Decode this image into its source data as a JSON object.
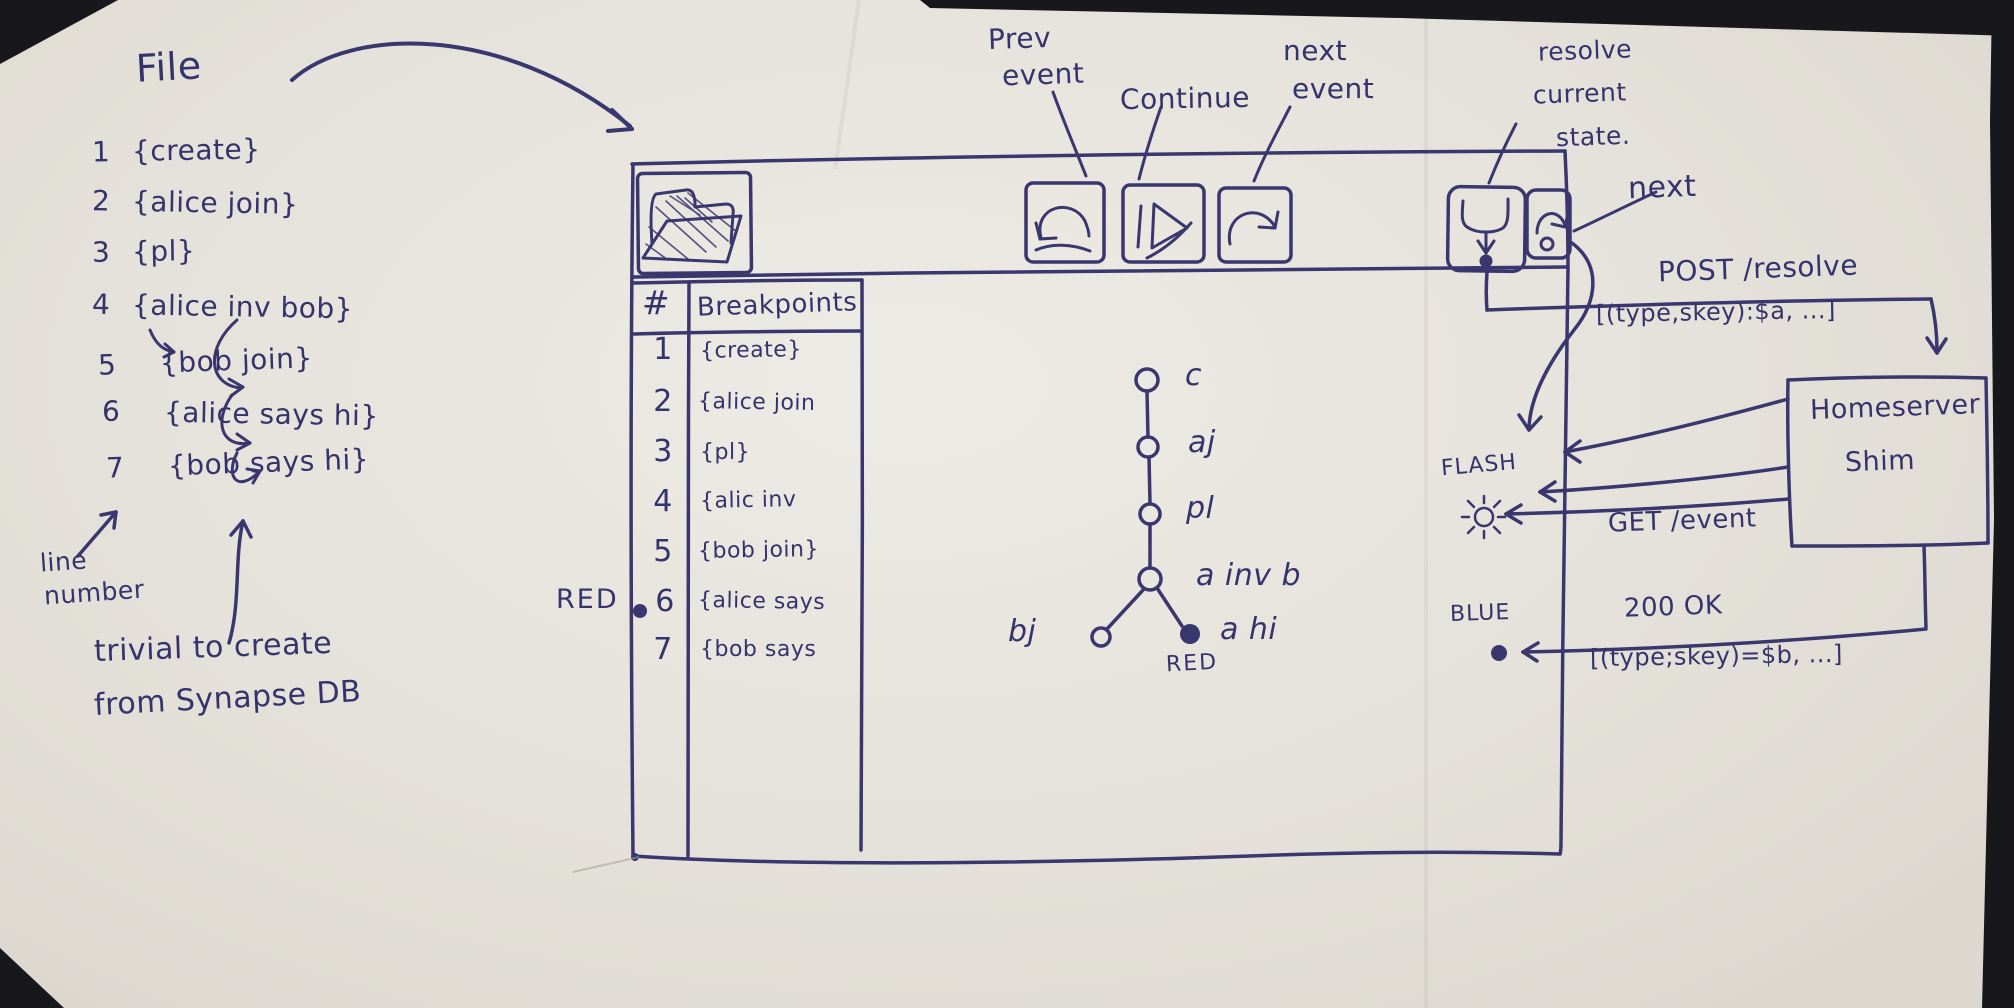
{
  "colors": {
    "ink": "#39376e",
    "paper": "#e3e1db",
    "red_marker": "RED",
    "blue_marker": "BLUE"
  },
  "file_panel": {
    "title": "File",
    "items": [
      {
        "num": "1",
        "text": "{create}"
      },
      {
        "num": "2",
        "text": "{alice join}"
      },
      {
        "num": "3",
        "text": "{pl}"
      },
      {
        "num": "4",
        "text": "{alice inv bob}"
      },
      {
        "num": "5",
        "text": "{bob join}"
      },
      {
        "num": "6",
        "text": "{alice says hi}"
      },
      {
        "num": "7",
        "text": "{bob says hi}"
      }
    ],
    "line_number_note": {
      "line1": "line",
      "line2": "number"
    },
    "footnote": {
      "line1": "trivial to create",
      "line2": "from Synapse DB"
    }
  },
  "toolbar": {
    "prev_event": {
      "line1": "Prev",
      "line2": "event"
    },
    "continue_label": "Continue",
    "next_event": {
      "line1": "next",
      "line2": "event"
    },
    "resolve_state": {
      "line1": "resolve",
      "line2": "current",
      "line3": "state."
    },
    "next_label": "next"
  },
  "breakpoints_table": {
    "col_num": "#",
    "col_title": "Breakpoints",
    "rows": [
      {
        "num": "1",
        "text": "{create}"
      },
      {
        "num": "2",
        "text": "{alice join"
      },
      {
        "num": "3",
        "text": "{pl}"
      },
      {
        "num": "4",
        "text": "{alic inv"
      },
      {
        "num": "5",
        "text": "{bob join}"
      },
      {
        "num": "6",
        "text": "{alice says"
      },
      {
        "num": "7",
        "text": "{bob says"
      }
    ],
    "breakpoint_row": "6",
    "red_label": "RED"
  },
  "dag": {
    "node_c": "c",
    "node_aj": "aj",
    "node_pl": "pl",
    "node_ainvb": "a inv b",
    "node_bj": "bj",
    "node_ahi": "a hi",
    "red_label": "RED"
  },
  "network": {
    "post_request": "POST /resolve",
    "post_body": "[(type,skey):$a, ...]",
    "get_request": "GET /event",
    "response": "200 OK",
    "response_body": "[(type;skey)=$b, ...]",
    "flash_label": "FLASH",
    "blue_label": "BLUE",
    "shim": {
      "line1": "Homeserver",
      "line2": "Shim"
    }
  }
}
